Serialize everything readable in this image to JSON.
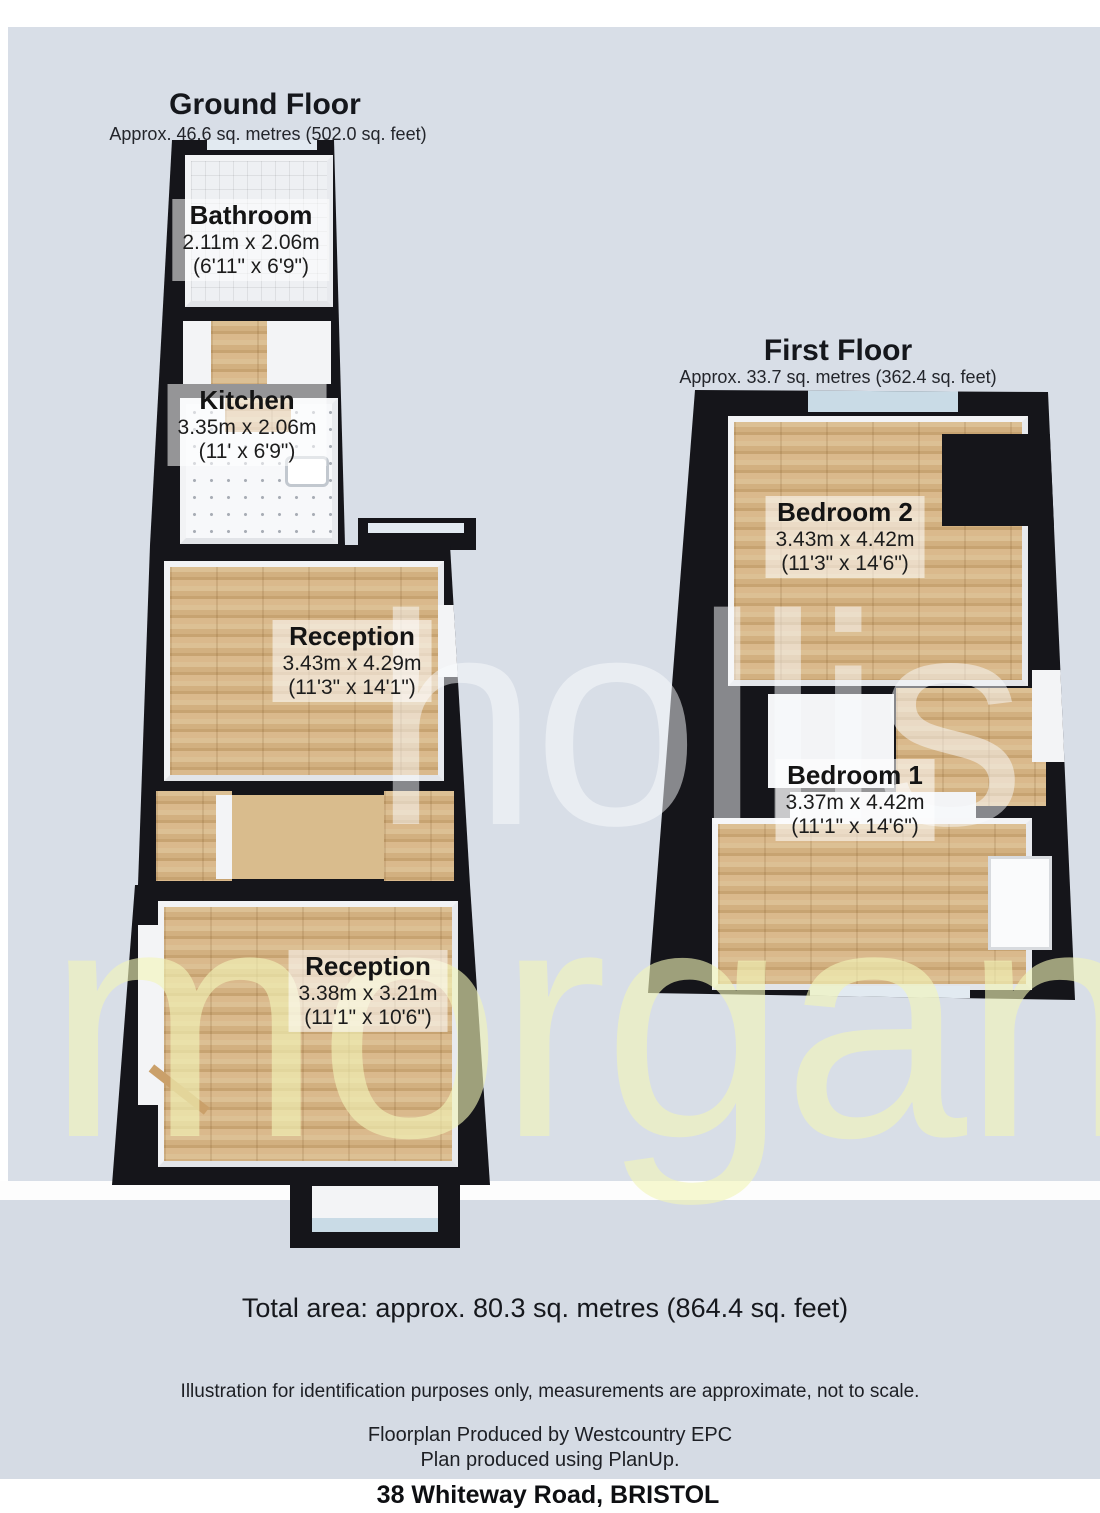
{
  "colors": {
    "panel": "#d8dee7",
    "wall": "#15151a",
    "wood_floor": "#d6b482",
    "watermark_yellow": "#f2f5b8",
    "watermark_gray": "#fafbfe"
  },
  "ground_floor": {
    "title": "Ground Floor",
    "area": "Approx.  46.6 sq. metres (502.0 sq. feet)",
    "rooms": [
      {
        "name": "Bathroom",
        "metric": "2.11m x 2.06m",
        "imperial": "(6'11\" x 6'9\")"
      },
      {
        "name": "Kitchen",
        "metric": "3.35m x 2.06m",
        "imperial": "(11' x 6'9\")"
      },
      {
        "name": "Reception",
        "metric": "3.43m x 4.29m",
        "imperial": "(11'3\" x 14'1\")"
      },
      {
        "name": "Reception",
        "metric": "3.38m x 3.21m",
        "imperial": "(11'1\" x 10'6\")"
      }
    ]
  },
  "first_floor": {
    "title": "First Floor",
    "area": "Approx.  33.7 sq. metres (362.4 sq. feet)",
    "rooms": [
      {
        "name": "Bedroom 2",
        "metric": "3.43m x 4.42m",
        "imperial": "(11'3\" x 14'6\")"
      },
      {
        "name": "Bedroom 1",
        "metric": "3.37m x 4.42m",
        "imperial": "(11'1\" x 14'6\")"
      }
    ]
  },
  "watermark": {
    "line1": "hollis",
    "line2": "morgan"
  },
  "footer": {
    "total_area": "Total area: approx.  80.3 sq. metres (864.4 sq. feet)",
    "disclaimer": "Illustration for identification purposes only, measurements are approximate, not to scale.",
    "produced_by": "Floorplan Produced by Westcountry EPC",
    "produced_with": "Plan produced using PlanUp.",
    "address": "38 Whiteway Road, BRISTOL"
  }
}
